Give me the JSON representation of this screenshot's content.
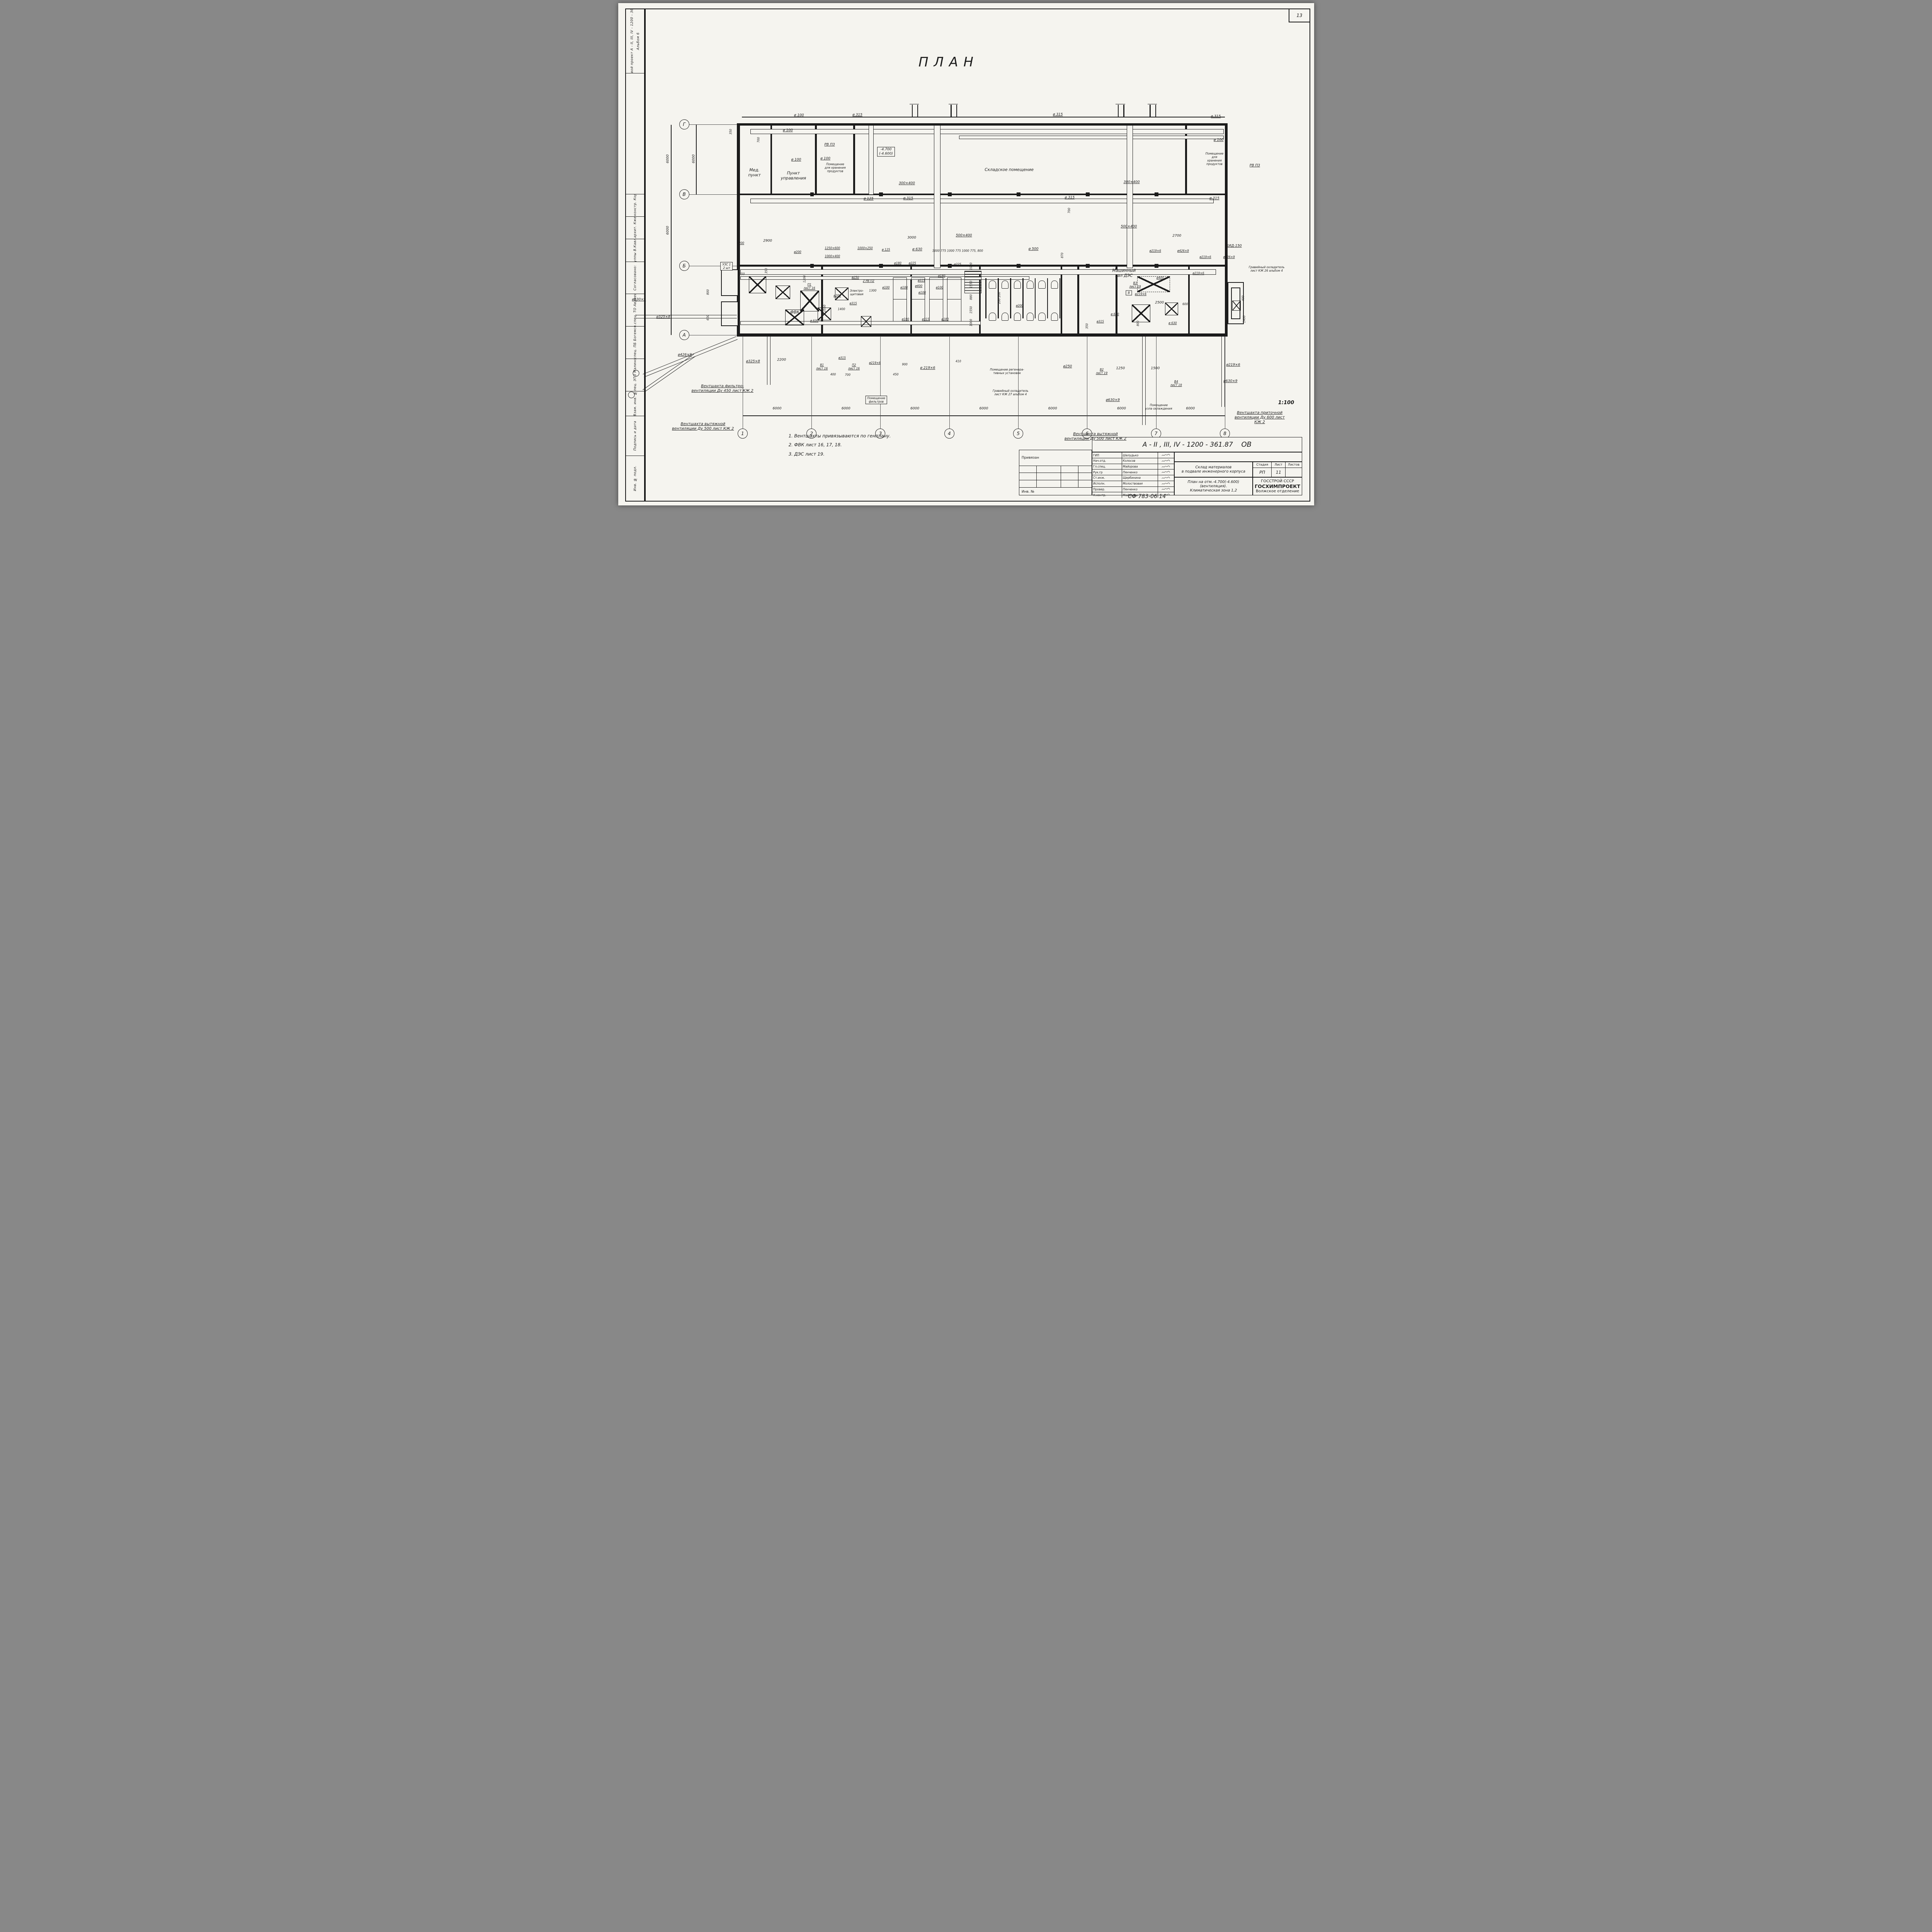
{
  "sheet": {
    "number": "13",
    "plan_title": "ПЛАН",
    "scale": "1:100",
    "stamp_code": "СФ  783-06  14"
  },
  "side_strip": {
    "project": "Типовой проект   А - II, III, IV - 1200 - 361.87",
    "album": "Альбом 6",
    "role1": "Рук.гр.констр.  Коробкин",
    "role2": "Рук.гр.архит.  Кженьшев",
    "role3": "Рук. группы  В.Кавлянская",
    "agreed": "Согласовано:",
    "agreed1": "Гл.спец. ТО  Авдеева",
    "agreed2": "Гл.спец. ПБ  Богемский",
    "agreed3": "Гл.спец. ЭТО  Малинский",
    "stamp1": "Взам. инв. №",
    "stamp2": "Подпись и дата",
    "stamp3": "Инв. № подл."
  },
  "notes": [
    "1. Вентшахты  привязываются  по  генплану.",
    "2. ФВК  лист  16, 17, 18.",
    "3. ДЭС  лист  19."
  ],
  "axes": {
    "bottom": [
      {
        "t": "1",
        "x": 17.9
      },
      {
        "t": "2",
        "x": 27.8
      },
      {
        "t": "3",
        "x": 37.7
      },
      {
        "t": "4",
        "x": 47.6
      },
      {
        "t": "5",
        "x": 57.5
      },
      {
        "t": "6",
        "x": 67.4
      },
      {
        "t": "7",
        "x": 77.3
      },
      {
        "t": "8",
        "x": 87.2
      }
    ],
    "left": [
      {
        "t": "Г",
        "y": 24.15
      },
      {
        "t": "В",
        "y": 38.05
      },
      {
        "t": "Б",
        "y": 52.3
      },
      {
        "t": "А",
        "y": 66.1
      }
    ]
  },
  "annotations": [
    {
      "t": "ø 100",
      "x": 26.0,
      "y": 22.4,
      "c": "c"
    },
    {
      "t": "ø 315",
      "x": 34.4,
      "y": 22.3,
      "c": "c"
    },
    {
      "t": "ø 315",
      "x": 63.2,
      "y": 22.2,
      "c": "c"
    },
    {
      "t": "ø 315",
      "x": 85.9,
      "y": 22.6,
      "c": "c"
    },
    {
      "t": "350",
      "x": 16.2,
      "y": 25.6,
      "c": "v d s"
    },
    {
      "t": "ø 100",
      "x": 24.4,
      "y": 25.4,
      "c": "c"
    },
    {
      "t": "700",
      "x": 20.2,
      "y": 27.2,
      "c": "v d s"
    },
    {
      "t": "РВ ПЗ",
      "x": 30.4,
      "y": 28.2,
      "c": "c"
    },
    {
      "t": "ø 100",
      "x": 86.3,
      "y": 27.3,
      "c": "c"
    },
    {
      "t": "Мед.\nпункт",
      "x": 19.6,
      "y": 33.8,
      "c": "r"
    },
    {
      "t": "Пункт\nуправления",
      "x": 25.2,
      "y": 34.4,
      "c": "r"
    },
    {
      "t": "Помещение\nдля хранения\nпродуктов",
      "x": 31.2,
      "y": 32.8,
      "c": "r s"
    },
    {
      "t": "ø 100",
      "x": 25.6,
      "y": 31.2,
      "c": "c"
    },
    {
      "t": "ø 100",
      "x": 29.8,
      "y": 31.0,
      "c": "c"
    },
    {
      "t": "-4.700\n(-4.600)",
      "x": 38.5,
      "y": 29.6,
      "c": "b d"
    },
    {
      "t": "Складское  помещение",
      "x": 56.2,
      "y": 33.2,
      "c": "r"
    },
    {
      "t": "300×400",
      "x": 41.5,
      "y": 35.9,
      "c": "c"
    },
    {
      "t": "300×400",
      "x": 73.8,
      "y": 35.7,
      "c": "c"
    },
    {
      "t": "Помещение\nдля\nхранения\nпродуктов",
      "x": 85.7,
      "y": 31.0,
      "c": "r s"
    },
    {
      "t": "РВ ПЗ",
      "x": 91.5,
      "y": 32.4,
      "c": "c"
    },
    {
      "t": "ø 125",
      "x": 36.0,
      "y": 39.0,
      "c": "c"
    },
    {
      "t": "ø 315",
      "x": 41.7,
      "y": 38.9,
      "c": "c"
    },
    {
      "t": "ø 315",
      "x": 64.9,
      "y": 38.8,
      "c": "c"
    },
    {
      "t": "ø 315",
      "x": 85.7,
      "y": 38.9,
      "c": "c"
    },
    {
      "t": "700",
      "x": 64.8,
      "y": 41.3,
      "c": "v d s"
    },
    {
      "t": "3000",
      "x": 42.2,
      "y": 46.8,
      "c": "d"
    },
    {
      "t": "500×400",
      "x": 49.7,
      "y": 46.3,
      "c": "c"
    },
    {
      "t": "500×400",
      "x": 73.4,
      "y": 44.5,
      "c": "c"
    },
    {
      "t": "2700",
      "x": 80.3,
      "y": 46.4,
      "c": "d"
    },
    {
      "t": "ø200",
      "x": 17.6,
      "y": 47.8,
      "c": "c s"
    },
    {
      "t": "2900",
      "x": 21.5,
      "y": 47.4,
      "c": "d"
    },
    {
      "t": "ø200",
      "x": 25.8,
      "y": 49.5,
      "c": "c s"
    },
    {
      "t": "1250×600",
      "x": 30.8,
      "y": 48.8,
      "c": "c s"
    },
    {
      "t": "1000×250",
      "x": 35.5,
      "y": 48.8,
      "c": "c s"
    },
    {
      "t": "1000×400",
      "x": 30.8,
      "y": 50.4,
      "c": "c s"
    },
    {
      "t": "ø 125",
      "x": 38.5,
      "y": 49.1,
      "c": "c s"
    },
    {
      "t": "ø 630",
      "x": 43.0,
      "y": 49.1,
      "c": "c"
    },
    {
      "t": "1000 775 1000 775 1000 775, 800",
      "x": 48.8,
      "y": 49.3,
      "c": "d s"
    },
    {
      "t": "ø 500",
      "x": 59.7,
      "y": 49.0,
      "c": "c"
    },
    {
      "t": "870",
      "x": 63.8,
      "y": 50.2,
      "c": "v d s"
    },
    {
      "t": "КИД-150",
      "x": 88.5,
      "y": 48.4,
      "c": "c"
    },
    {
      "t": "ø219×6",
      "x": 84.4,
      "y": 50.5,
      "c": "c s"
    },
    {
      "t": "ø426×9",
      "x": 87.8,
      "y": 50.5,
      "c": "c s"
    },
    {
      "t": "УЗС 1\n2 шт",
      "x": 15.6,
      "y": 52.4,
      "c": "b s"
    },
    {
      "t": "250",
      "x": 17.8,
      "y": 53.9,
      "c": "d s"
    },
    {
      "t": "350",
      "x": 21.3,
      "y": 53.3,
      "c": "v d s"
    },
    {
      "t": "1200",
      "x": 26.8,
      "y": 54.9,
      "c": "v d s"
    },
    {
      "t": "П1\nлист 16",
      "x": 27.5,
      "y": 56.4,
      "c": "c s"
    },
    {
      "t": "2 РВ П2",
      "x": 36.0,
      "y": 55.3,
      "c": "c s"
    },
    {
      "t": "Электро-\nщитовая",
      "x": 34.3,
      "y": 57.6,
      "c": "r s"
    },
    {
      "t": "ø250",
      "x": 34.1,
      "y": 54.6,
      "c": "c s"
    },
    {
      "t": "ø200",
      "x": 31.5,
      "y": 58.2,
      "c": "c s"
    },
    {
      "t": "ø315",
      "x": 33.8,
      "y": 59.8,
      "c": "c s"
    },
    {
      "t": "1400",
      "x": 32.1,
      "y": 60.9,
      "c": "d s"
    },
    {
      "t": "1300",
      "x": 36.6,
      "y": 57.2,
      "c": "d s"
    },
    {
      "t": "ФВК",
      "x": 25.4,
      "y": 61.6,
      "c": "r"
    },
    {
      "t": "ø 630",
      "x": 28.2,
      "y": 63.2,
      "c": "c s"
    },
    {
      "t": "ø325×8",
      "x": 6.5,
      "y": 62.5,
      "c": "c"
    },
    {
      "t": "ø630×9",
      "x": 3.0,
      "y": 59.1,
      "c": "c"
    },
    {
      "t": "800",
      "x": 12.9,
      "y": 57.5,
      "c": "v d s"
    },
    {
      "t": "600",
      "x": 12.9,
      "y": 62.6,
      "c": "v d s"
    },
    {
      "t": "2550",
      "x": 29.7,
      "y": 60.8,
      "c": "v d s"
    },
    {
      "t": "ø180",
      "x": 40.2,
      "y": 51.8,
      "c": "c s"
    },
    {
      "t": "ø225",
      "x": 42.3,
      "y": 51.8,
      "c": "c s"
    },
    {
      "t": "ø225",
      "x": 48.8,
      "y": 52.0,
      "c": "c s"
    },
    {
      "t": "ø180",
      "x": 46.5,
      "y": 54.3,
      "c": "c s"
    },
    {
      "t": "ø315",
      "x": 43.6,
      "y": 55.2,
      "c": "c s"
    },
    {
      "t": "ø400",
      "x": 43.2,
      "y": 56.3,
      "c": "c s"
    },
    {
      "t": "ø100",
      "x": 38.5,
      "y": 56.6,
      "c": "c s"
    },
    {
      "t": "ø100",
      "x": 41.1,
      "y": 56.6,
      "c": "c s"
    },
    {
      "t": "ø100",
      "x": 43.7,
      "y": 57.6,
      "c": "c s"
    },
    {
      "t": "ø100",
      "x": 46.2,
      "y": 56.6,
      "c": "c s"
    },
    {
      "t": "1000",
      "x": 50.7,
      "y": 52.4,
      "c": "v d s"
    },
    {
      "t": "1550",
      "x": 50.7,
      "y": 56.0,
      "c": "v d s"
    },
    {
      "t": "880",
      "x": 50.7,
      "y": 58.5,
      "c": "v d s"
    },
    {
      "t": "1550",
      "x": 50.7,
      "y": 61.1,
      "c": "v d s"
    },
    {
      "t": "1000",
      "x": 50.7,
      "y": 63.6,
      "c": "v d s"
    },
    {
      "t": "ø180",
      "x": 41.3,
      "y": 62.9,
      "c": "c s"
    },
    {
      "t": "ø315",
      "x": 44.2,
      "y": 62.9,
      "c": "c s"
    },
    {
      "t": "ø180",
      "x": 47.0,
      "y": 62.9,
      "c": "c s"
    },
    {
      "t": "200  200",
      "x": 54.8,
      "y": 58.7,
      "c": "v d s"
    },
    {
      "t": "ø200",
      "x": 57.7,
      "y": 60.2,
      "c": "c s"
    },
    {
      "t": "Машинный\nзал ДЭС",
      "x": 72.7,
      "y": 53.8,
      "c": "r"
    },
    {
      "t": "ø219×6",
      "x": 77.2,
      "y": 49.3,
      "c": "c s"
    },
    {
      "t": "ø426×9",
      "x": 81.2,
      "y": 49.3,
      "c": "c s"
    },
    {
      "t": "ø400",
      "x": 77.9,
      "y": 54.7,
      "c": "c s"
    },
    {
      "t": "ø219×6",
      "x": 83.4,
      "y": 53.8,
      "c": "c s"
    },
    {
      "t": "В3\nлист 19",
      "x": 74.3,
      "y": 56.1,
      "c": "c s"
    },
    {
      "t": "ø219×6",
      "x": 75.1,
      "y": 57.9,
      "c": "c s"
    },
    {
      "t": "Гравийный охладитель\nлист КЖ 26 альбом 4",
      "x": 93.2,
      "y": 52.9,
      "c": "r s"
    },
    {
      "t": "400",
      "x": 89.8,
      "y": 58.8,
      "c": "v d s"
    },
    {
      "t": "1400",
      "x": 90.0,
      "y": 62.9,
      "c": "v d s"
    },
    {
      "t": "2500",
      "x": 77.8,
      "y": 59.7,
      "c": "d"
    },
    {
      "t": "600",
      "x": 81.5,
      "y": 59.9,
      "c": "d s"
    },
    {
      "t": "ø 630",
      "x": 71.4,
      "y": 61.9,
      "c": "c s"
    },
    {
      "t": "800",
      "x": 74.7,
      "y": 63.8,
      "c": "v d s"
    },
    {
      "t": "ø315",
      "x": 69.3,
      "y": 63.4,
      "c": "c s"
    },
    {
      "t": "350",
      "x": 67.4,
      "y": 64.3,
      "c": "v d s"
    },
    {
      "t": "ø 630",
      "x": 79.7,
      "y": 63.7,
      "c": "c s"
    },
    {
      "t": "В",
      "x": 73.4,
      "y": 57.7,
      "c": "b s"
    },
    {
      "t": "ø325×8",
      "x": 19.4,
      "y": 71.4,
      "c": "c"
    },
    {
      "t": "2200",
      "x": 23.5,
      "y": 71.1,
      "c": "d"
    },
    {
      "t": "В1\nлист 16",
      "x": 29.3,
      "y": 72.4,
      "c": "c s"
    },
    {
      "t": "ø315",
      "x": 32.2,
      "y": 70.6,
      "c": "c s"
    },
    {
      "t": "П2\nлист 16",
      "x": 33.9,
      "y": 72.4,
      "c": "c s"
    },
    {
      "t": "ø219×6",
      "x": 36.9,
      "y": 71.6,
      "c": "c s"
    },
    {
      "t": "700",
      "x": 33.0,
      "y": 74.0,
      "c": "d s"
    },
    {
      "t": "400",
      "x": 30.9,
      "y": 73.9,
      "c": "d s"
    },
    {
      "t": "450",
      "x": 39.9,
      "y": 73.9,
      "c": "d s"
    },
    {
      "t": "900",
      "x": 41.2,
      "y": 71.9,
      "c": "d s"
    },
    {
      "t": "ø 219×6",
      "x": 44.5,
      "y": 72.7,
      "c": "c"
    },
    {
      "t": "410",
      "x": 48.9,
      "y": 71.3,
      "c": "d s"
    },
    {
      "t": "ø250",
      "x": 64.6,
      "y": 72.4,
      "c": "c"
    },
    {
      "t": "В2\nлист 19",
      "x": 69.5,
      "y": 73.3,
      "c": "c s"
    },
    {
      "t": "1250",
      "x": 72.2,
      "y": 72.8,
      "c": "d"
    },
    {
      "t": "1500",
      "x": 77.2,
      "y": 72.8,
      "c": "d"
    },
    {
      "t": "В4\nлист 19",
      "x": 80.2,
      "y": 75.7,
      "c": "c s"
    },
    {
      "t": "ø630×9",
      "x": 71.1,
      "y": 79.1,
      "c": "c"
    },
    {
      "t": "ø630×9",
      "x": 88.0,
      "y": 75.3,
      "c": "c"
    },
    {
      "t": "ø219×6",
      "x": 88.4,
      "y": 72.1,
      "c": "c"
    },
    {
      "t": "ø426×9",
      "x": 9.6,
      "y": 70.1,
      "c": "c"
    },
    {
      "t": "Вентшахта фильтро-\nвентиляции Ду 450 лист КЖ 2",
      "x": 15.0,
      "y": 76.8,
      "c": "n"
    },
    {
      "t": "Вентшахта вытяжной\nвентиляции Ду 500 лист КЖ 2",
      "x": 12.2,
      "y": 84.3,
      "c": "n"
    },
    {
      "t": "Помещение регенера-\nтивных установок",
      "x": 55.9,
      "y": 73.3,
      "c": "r s"
    },
    {
      "t": "Гравийный охладитель\nлист КЖ 27 альбом 4",
      "x": 56.4,
      "y": 77.5,
      "c": "r s"
    },
    {
      "t": "Помещение\nфильтров",
      "x": 37.1,
      "y": 79.0,
      "c": "r s b"
    },
    {
      "t": "Вентшахта вытяжной\nвентиляции Ду 500 лист КЖ 2",
      "x": 68.6,
      "y": 86.3,
      "c": "n"
    },
    {
      "t": "Вентшахта приточной\nвентиляции Ду 600 лист КЖ 2",
      "x": 92.2,
      "y": 82.5,
      "c": "n"
    },
    {
      "t": "Помещение\nузла охлаждения",
      "x": 77.7,
      "y": 80.4,
      "c": "r s"
    },
    {
      "t": "1:100",
      "x": 96.0,
      "y": 79.6,
      "c": "m"
    },
    {
      "t": "6000",
      "x": 7.2,
      "y": 31.0,
      "c": "v d"
    },
    {
      "t": "6000",
      "x": 10.9,
      "y": 31.0,
      "c": "v d"
    },
    {
      "t": "6000",
      "x": 7.2,
      "y": 45.2,
      "c": "v d"
    },
    {
      "t": "6000",
      "x": 22.85,
      "y": 80.8,
      "c": "d"
    },
    {
      "t": "6000",
      "x": 32.75,
      "y": 80.8,
      "c": "d"
    },
    {
      "t": "6000",
      "x": 42.65,
      "y": 80.8,
      "c": "d"
    },
    {
      "t": "6000",
      "x": 52.55,
      "y": 80.8,
      "c": "d"
    },
    {
      "t": "6000",
      "x": 62.45,
      "y": 80.8,
      "c": "d"
    },
    {
      "t": "6000",
      "x": 72.35,
      "y": 80.8,
      "c": "d"
    },
    {
      "t": "6000",
      "x": 82.25,
      "y": 80.8,
      "c": "d"
    }
  ],
  "title_block": {
    "doc_number": "А - II , III, IV   - 1200 - 361.87",
    "mark": "ОВ",
    "rows": [
      {
        "role": "ГИП",
        "name": "Шелудько"
      },
      {
        "role": "Нач.отд.",
        "name": "Колосов"
      },
      {
        "role": "Гл.спец.",
        "name": "Майорова"
      },
      {
        "role": "Рук.гр",
        "name": "Пянченко"
      },
      {
        "role": "Ст.инж.",
        "name": "Щербинина"
      },
      {
        "role": "Исполн.",
        "name": "Молоствовая"
      },
      {
        "role": "Провер.",
        "name": "Пянченко"
      },
      {
        "role": "Н.контр.",
        "name": "Майорова"
      }
    ],
    "object": "Склад материалов\nв подвале инженерного корпуса",
    "drawing_title": "План на отм.-4.700(-4.600)\n(вентиляция).\nКлиматическая зона 1,2",
    "stage_label": "Стадия",
    "sheet_label": "Лист",
    "sheets_label": "Листов",
    "stage": "РП",
    "sheet": "11",
    "sheets": "",
    "org1": "ГОССТРОЙ СССР",
    "org2": "ГОСХИМПРОЕКТ",
    "org3": "Волжское отделение",
    "attached_label": "Привязан",
    "inv_label": "Инв. №"
  }
}
